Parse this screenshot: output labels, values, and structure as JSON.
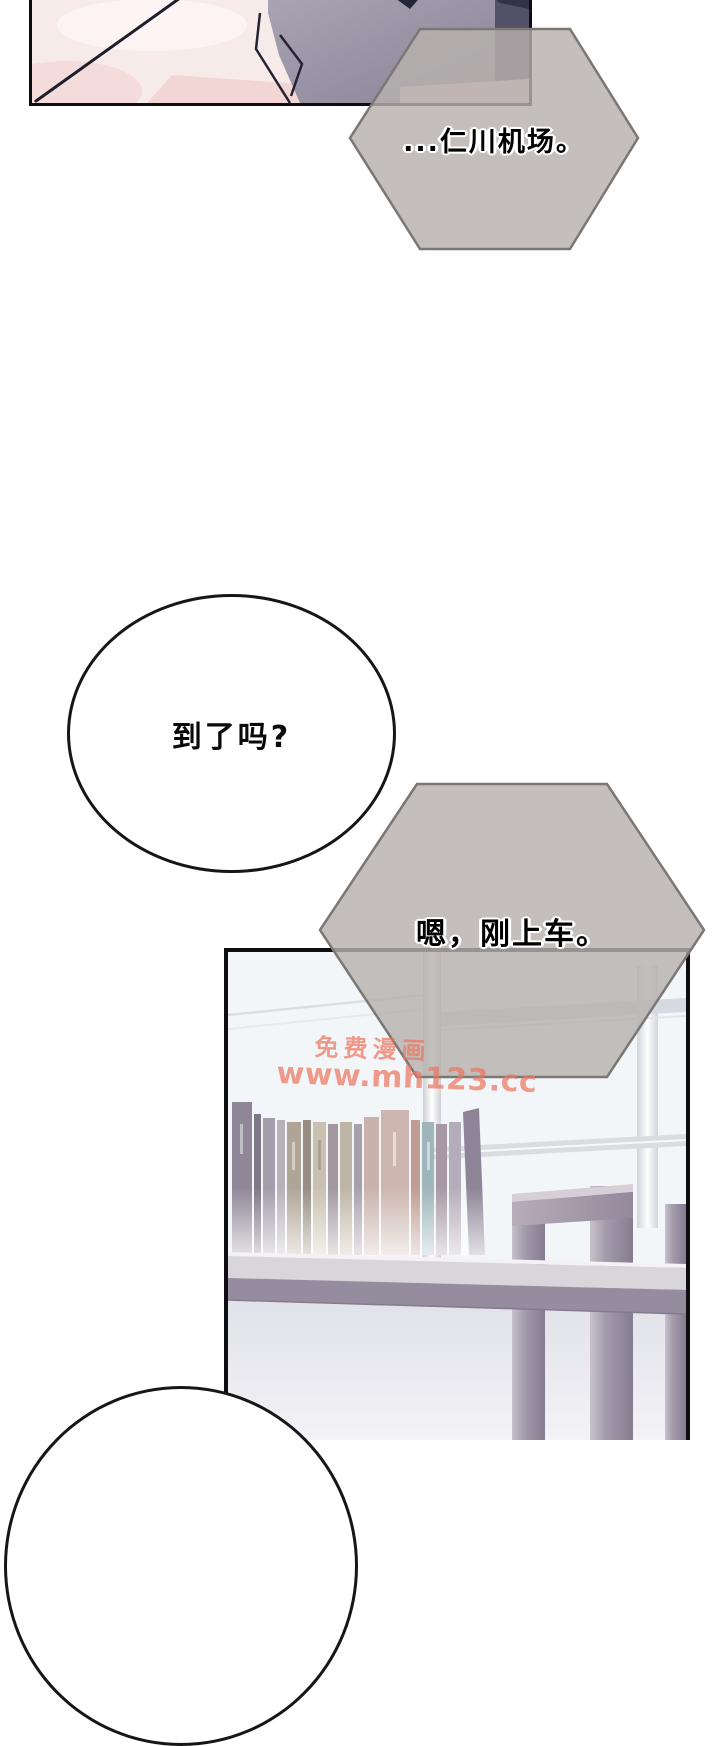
{
  "comic": {
    "bubbles": {
      "hex1": {
        "shape": "hexagon",
        "text": "...仁川机场。"
      },
      "thought1": {
        "shape": "ellipse",
        "text": "到了吗?"
      },
      "hex2": {
        "shape": "hexagon",
        "text": "嗯，刚上车。"
      },
      "thought2": {
        "shape": "ellipse",
        "text": ""
      }
    },
    "watermark": {
      "line1": "免费漫画",
      "line2": "www.mh123.cc"
    }
  },
  "colors": {
    "page_bg": "#ffffff",
    "panel_border": "#0e0e12",
    "hex_stroke": "#7b7874",
    "hex_fill": "rgba(183,177,174,0.82)",
    "bubble_bg": "#ffffff",
    "bubble_stroke": "#161616",
    "watermark": "rgba(236,118,96,0.72)",
    "skin": "#f7ebe9",
    "fabric_dark": "#8a8696"
  }
}
